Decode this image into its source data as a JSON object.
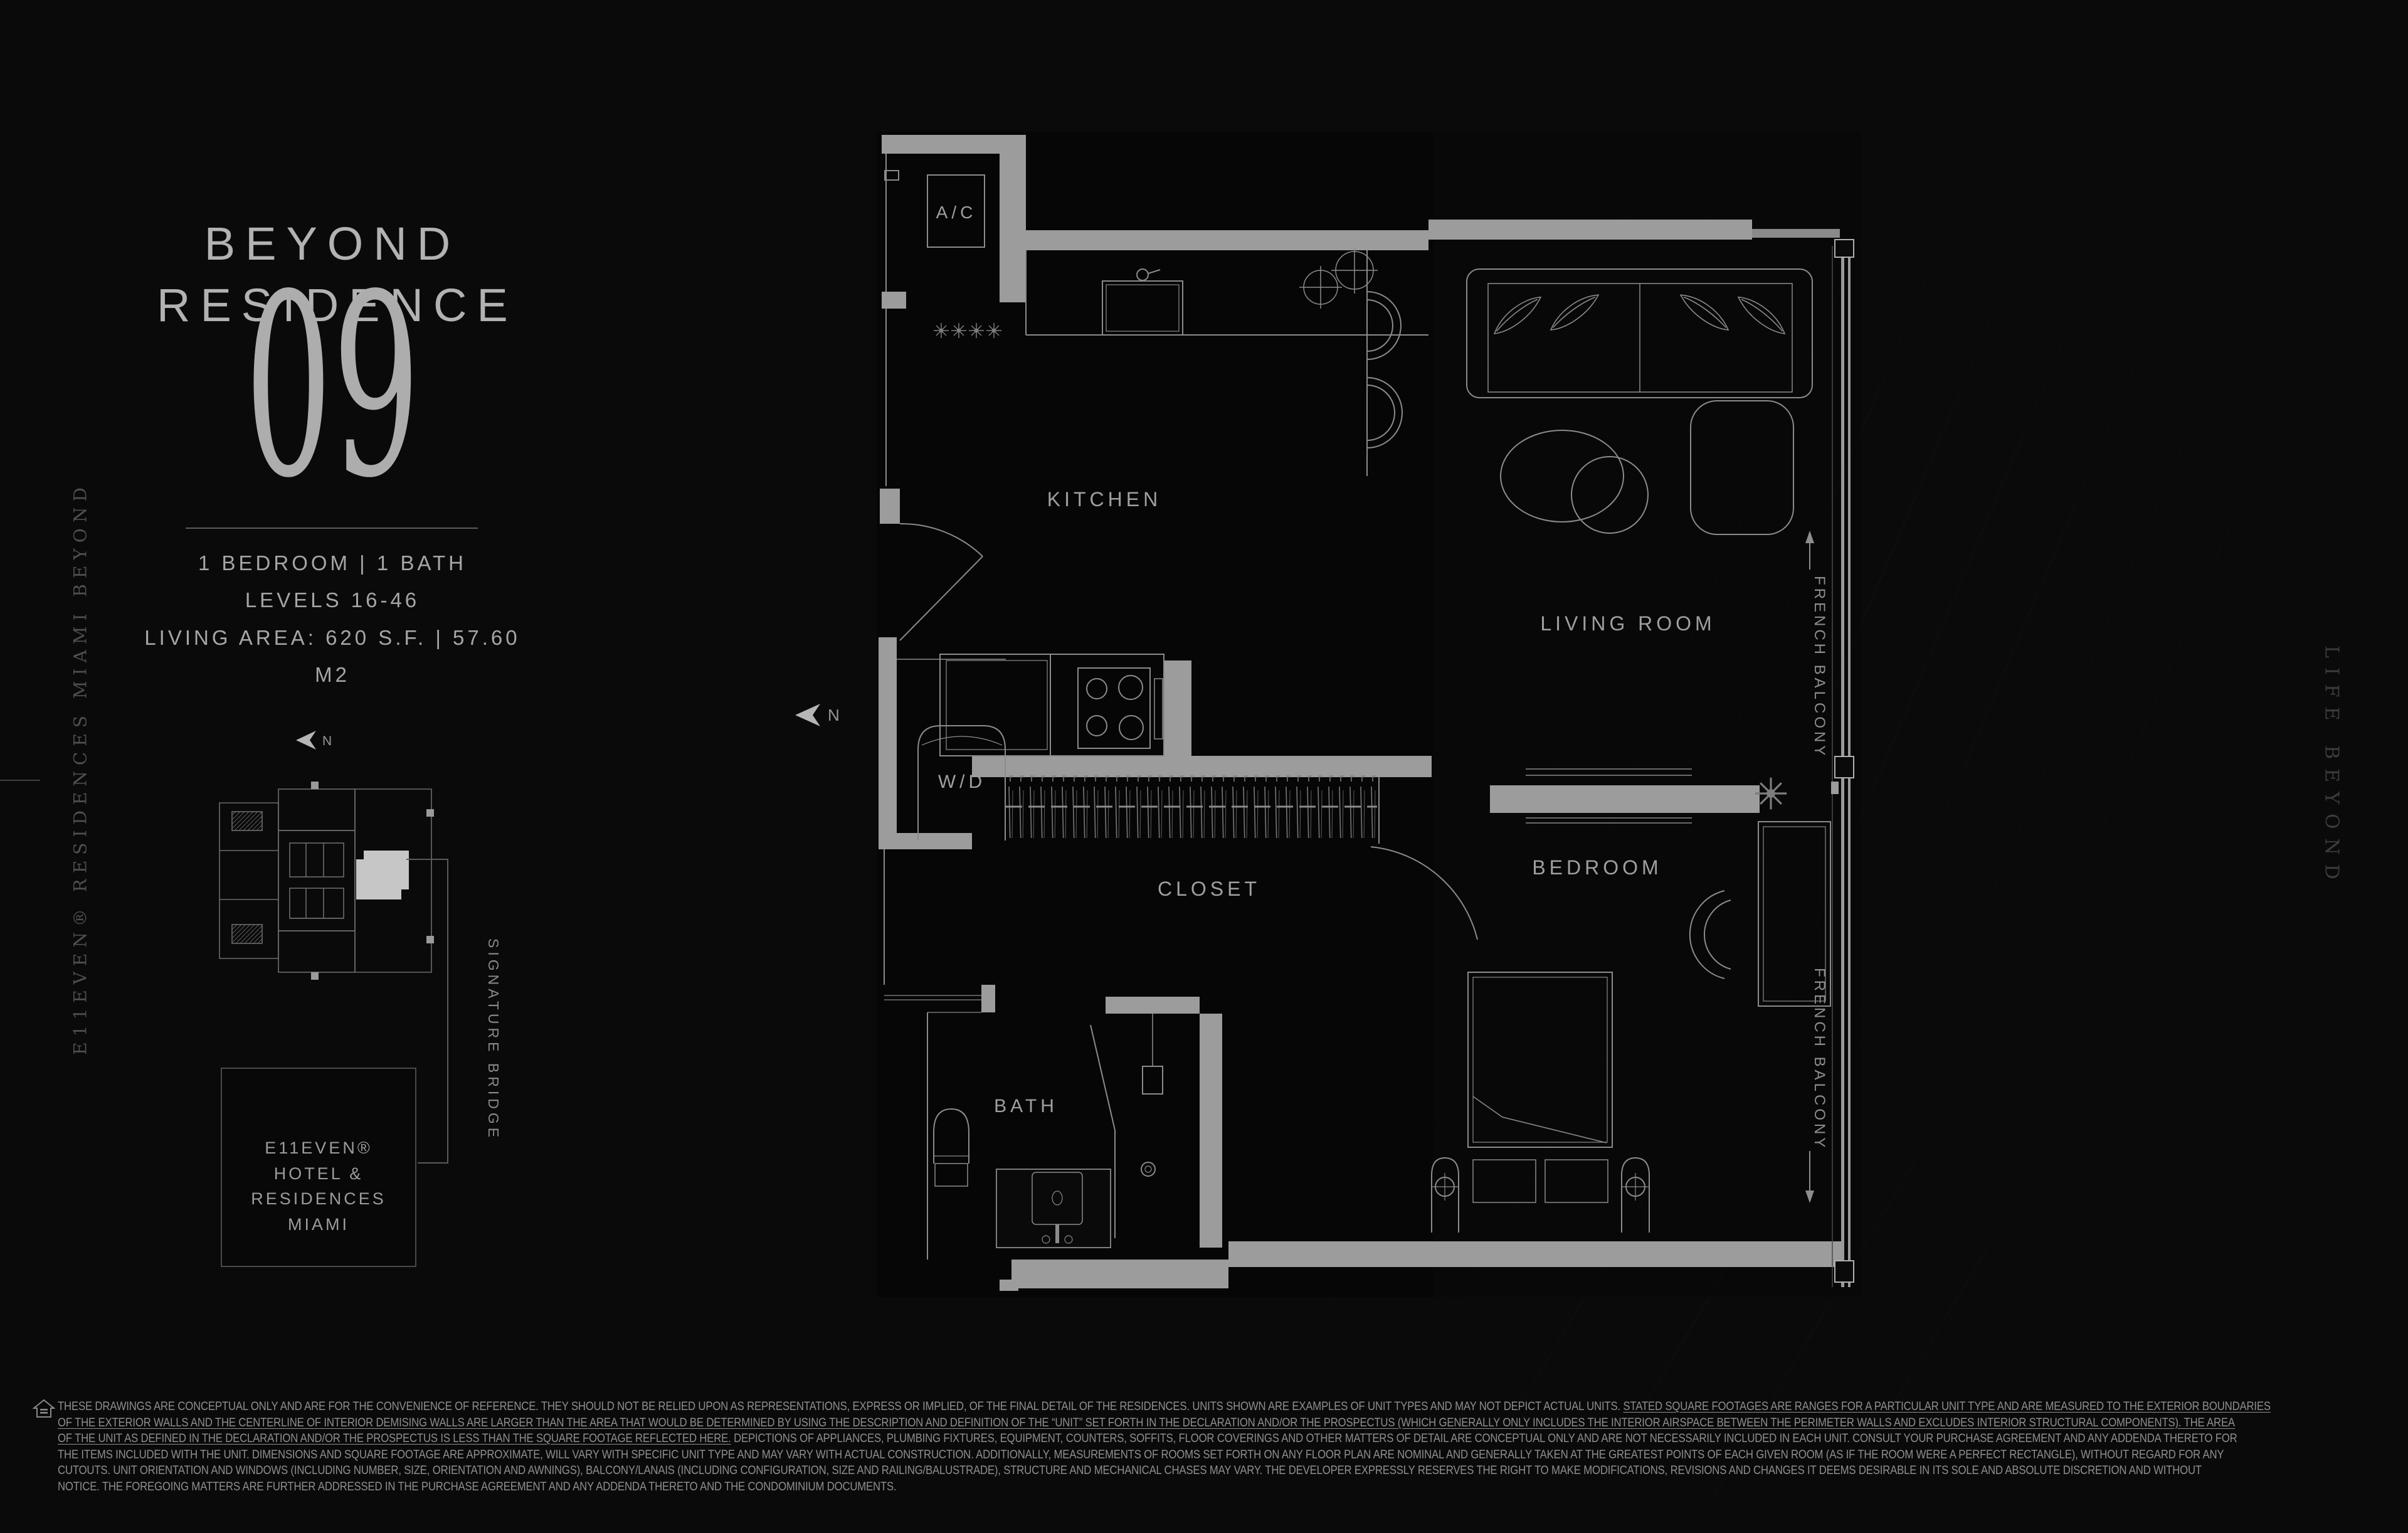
{
  "header": {
    "brand_top": "BEYOND",
    "brand_bottom": "RESIDENCE",
    "unit": "09"
  },
  "specs": {
    "beds_baths": "1 BEDROOM  |  1 BATH",
    "levels": "LEVELS 16-46",
    "living_area": "LIVING AREA: 620 S.F.  |  57.60  M2"
  },
  "vertical_left": "E11EVEN® RESIDENCES MIAMI BEYOND",
  "vertical_right": "LIFE BEYOND",
  "keyplan": {
    "north": "N",
    "bridge": "SIGNATURE BRIDGE"
  },
  "brand_box": {
    "line1": "E11EVEN®",
    "line2": "HOTEL & RESIDENCES",
    "line3": "MIAMI"
  },
  "plan": {
    "north": "N",
    "labels": {
      "ac": "A/C",
      "kitchen": "KITCHEN",
      "living_room": "LIVING ROOM",
      "wd": "W/D",
      "closet": "CLOSET",
      "bedroom": "BEDROOM",
      "bath": "BATH",
      "balcony_upper": "FRENCH BALCONY",
      "balcony_lower": "FRENCH BALCONY"
    }
  },
  "disclaimer": {
    "lines": [
      [
        {
          "t": "THESE DRAWINGS ARE CONCEPTUAL ONLY AND ARE FOR THE CONVENIENCE OF REFERENCE. THEY SHOULD NOT BE RELIED UPON AS REPRESENTATIONS, EXPRESS OR IMPLIED, OF THE FINAL DETAIL OF THE RESIDENCES. UNITS SHOWN ARE EXAMPLES OF UNIT TYPES AND MAY NOT DEPICT ACTUAL UNITS. ",
          "u": false
        },
        {
          "t": "STATED SQUARE FOOTAGES ARE RANGES FOR A PARTICULAR UNIT TYPE AND ARE MEASURED TO THE EXTERIOR BOUNDARIES",
          "u": true
        }
      ],
      [
        {
          "t": "OF THE EXTERIOR WALLS AND THE CENTERLINE OF INTERIOR DEMISING WALLS ARE LARGER THAN THE AREA THAT WOULD BE DETERMINED BY USING THE DESCRIPTION AND DEFINITION OF THE “UNIT” SET FORTH IN THE DECLARATION AND/OR THE PROSPECTUS (WHICH GENERALLY ONLY INCLUDES THE INTERIOR AIRSPACE BETWEEN THE PERIMETER WALLS AND EXCLUDES INTERIOR STRUCTURAL COMPONENTS). THE AREA",
          "u": true
        }
      ],
      [
        {
          "t": "OF THE UNIT AS DEFINED IN THE DECLARATION AND/OR THE PROSPECTUS IS LESS THAN THE SQUARE FOOTAGE REFLECTED HERE.",
          "u": true
        },
        {
          "t": " DEPICTIONS OF APPLIANCES, PLUMBING FIXTURES, EQUIPMENT, COUNTERS, SOFFITS, FLOOR COVERINGS AND OTHER MATTERS OF DETAIL ARE CONCEPTUAL ONLY AND ARE NOT NECESSARILY INCLUDED IN EACH UNIT. CONSULT YOUR PURCHASE AGREEMENT AND ANY ADDENDA THERETO FOR",
          "u": false
        }
      ],
      [
        {
          "t": "THE ITEMS INCLUDED WITH THE UNIT. DIMENSIONS AND SQUARE FOOTAGE ARE APPROXIMATE, WILL VARY WITH SPECIFIC UNIT TYPE AND MAY VARY WITH ACTUAL CONSTRUCTION. ADDITIONALLY, MEASUREMENTS OF ROOMS SET FORTH ON ANY FLOOR PLAN ARE NOMINAL AND GENERALLY TAKEN AT THE GREATEST POINTS OF EACH GIVEN ROOM (AS IF THE ROOM WERE A PERFECT RECTANGLE), WITHOUT REGARD FOR ANY",
          "u": false
        }
      ],
      [
        {
          "t": "CUTOUTS. UNIT ORIENTATION AND WINDOWS (INCLUDING NUMBER, SIZE, ORIENTATION AND AWNINGS), BALCONY/LANAIS (INCLUDING CONFIGURATION, SIZE AND RAILING/BALUSTRADE), STRUCTURE AND MECHANICAL CHASES MAY VARY. THE DEVELOPER EXPRESSLY RESERVES THE RIGHT TO MAKE MODIFICATIONS, REVISIONS AND CHANGES IT DEEMS DESIRABLE IN ITS SOLE AND ABSOLUTE DISCRETION AND WITHOUT",
          "u": false
        }
      ],
      [
        {
          "t": "NOTICE. THE FOREGOING MATTERS ARE FURTHER ADDRESSED IN THE PURCHASE AGREEMENT AND ANY ADDENDA THERETO AND THE CONDOMINIUM DOCUMENTS.",
          "u": false
        }
      ]
    ]
  },
  "colors": {
    "background": "#0a0a0a",
    "wall_gray": "#9c9c9c",
    "line_gray": "#8b8b8b",
    "text_primary": "#b2b2b2",
    "text_muted": "#8f8f8f",
    "highlight_unit": "#c6c6c6"
  }
}
